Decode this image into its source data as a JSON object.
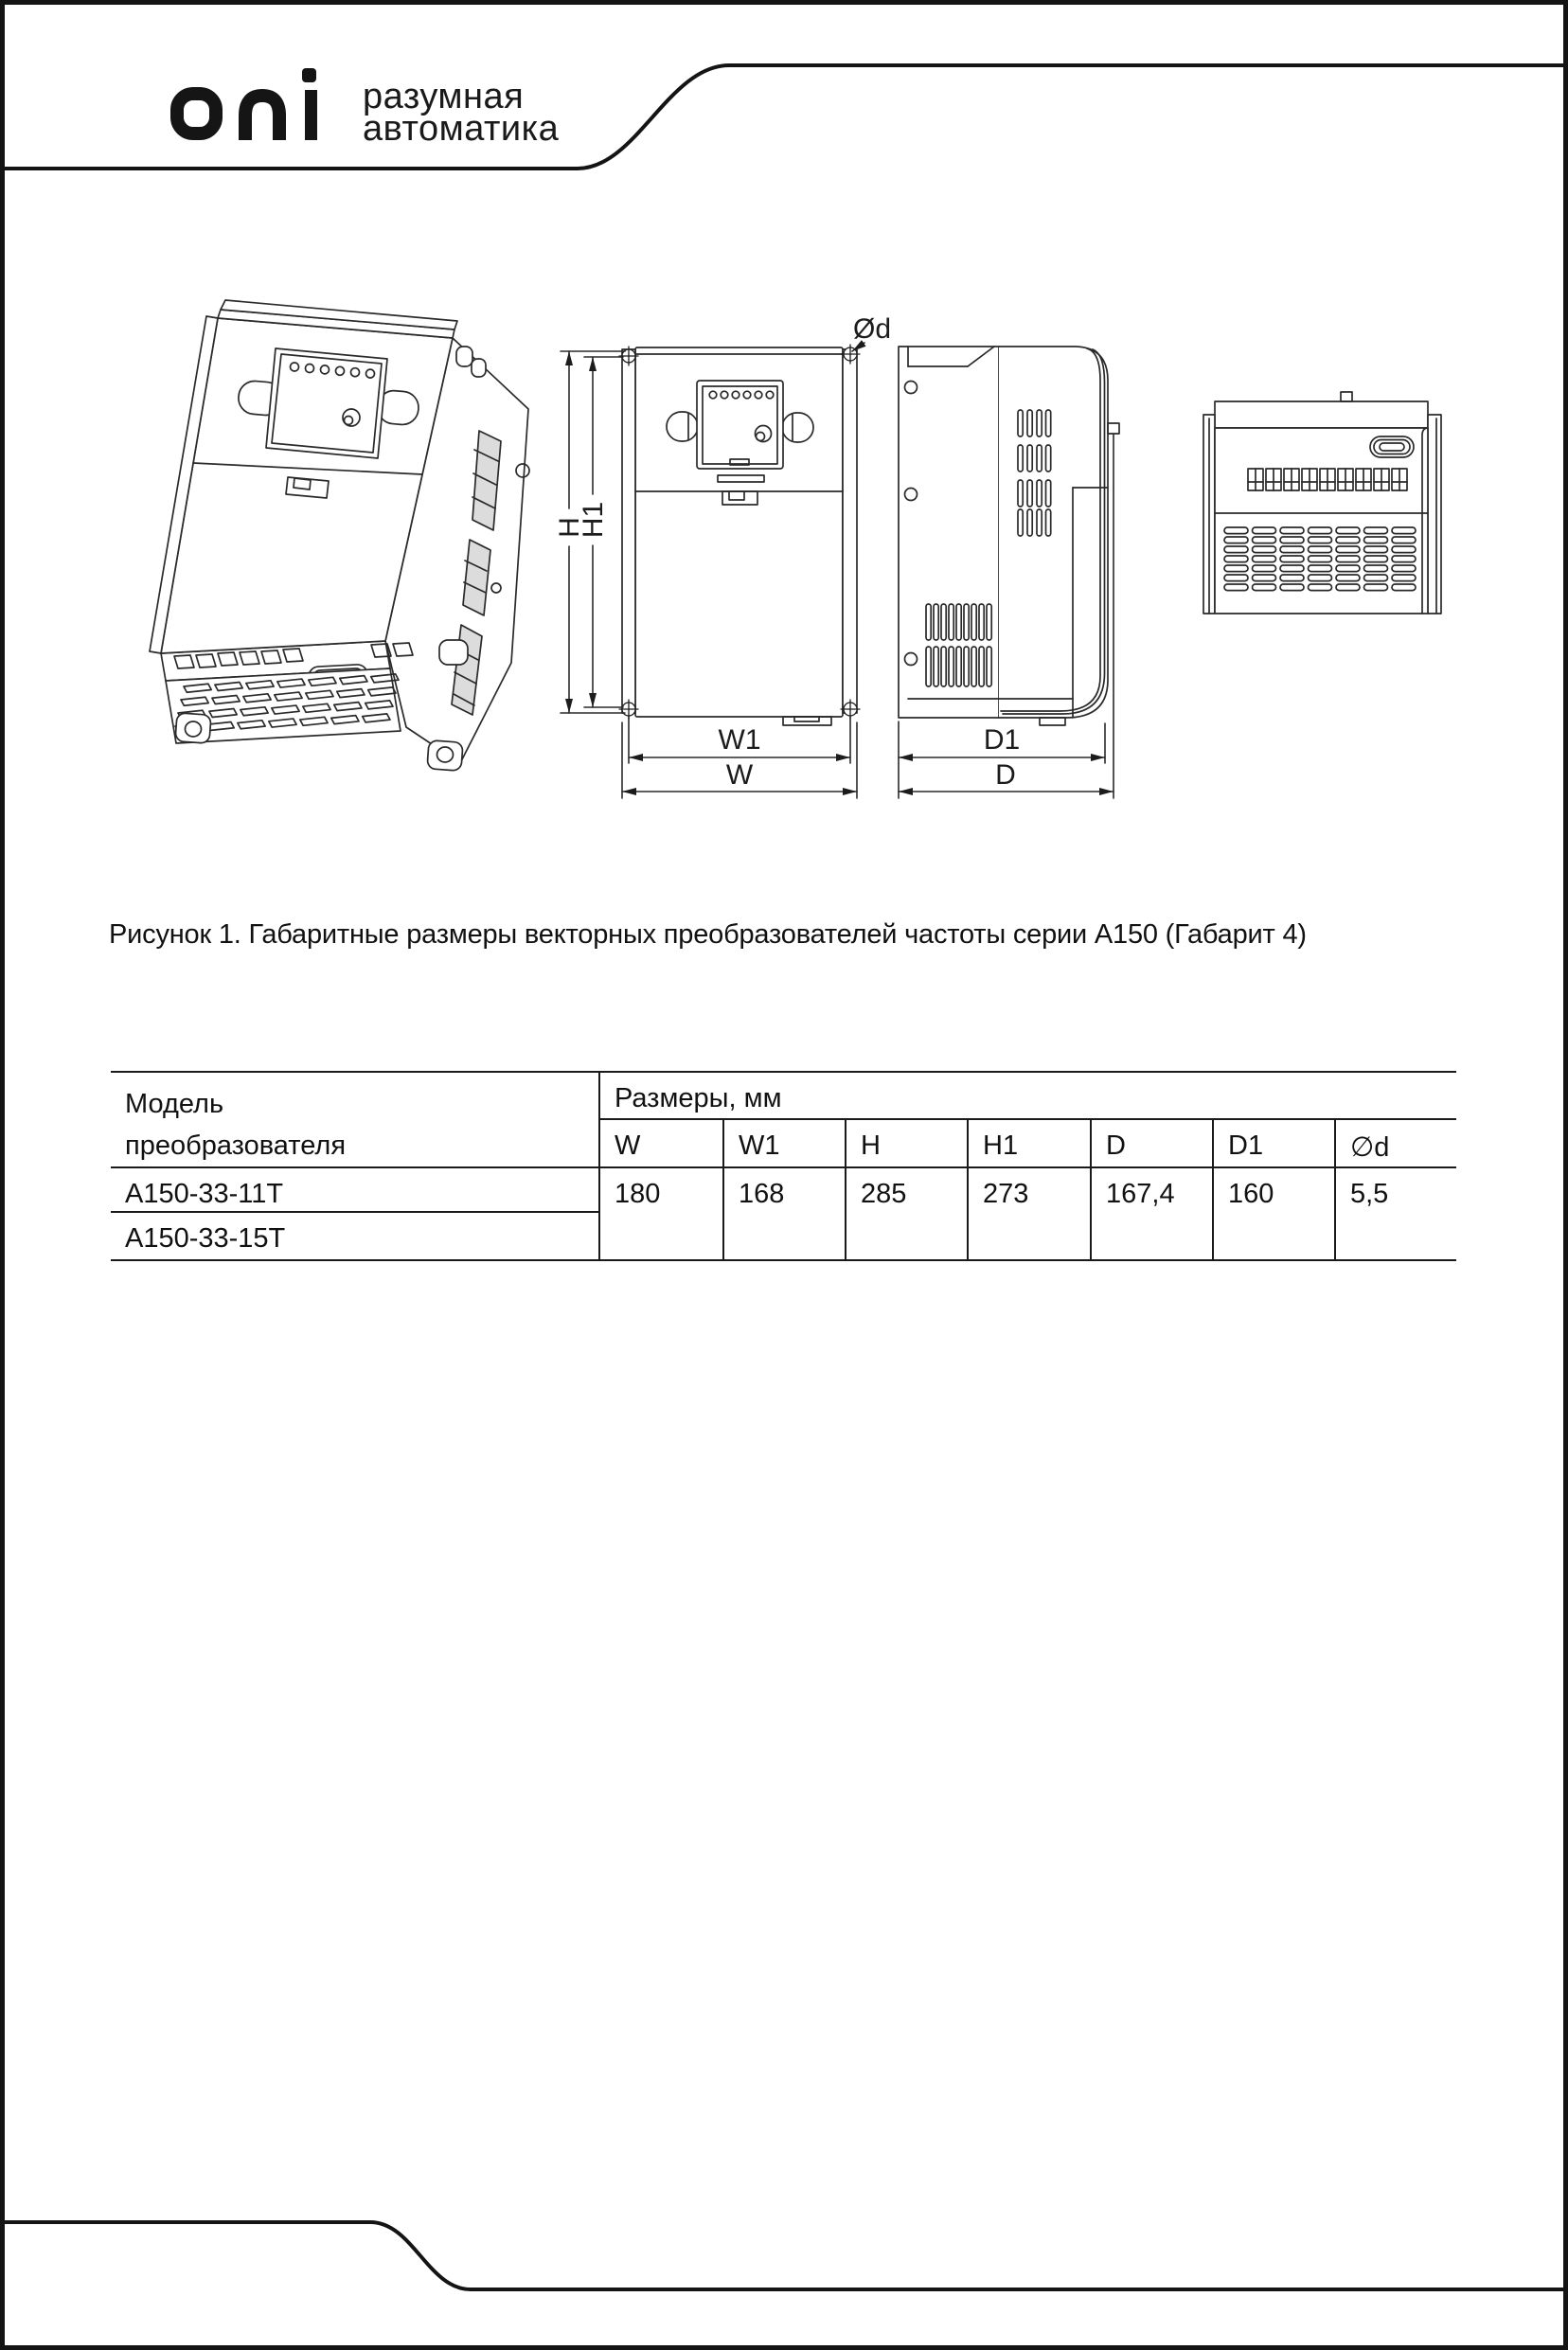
{
  "colors": {
    "ink": "#1c1c1c",
    "background": "#ffffff"
  },
  "brand": {
    "logo_text": "oni",
    "tagline_line1": "разумная",
    "tagline_line2": "автоматика"
  },
  "figure": {
    "caption": "Рисунок 1. Габаритные размеры векторных преобразователей частоты серии А150 (Габарит 4)"
  },
  "drawing": {
    "labels": {
      "height_total": "H",
      "height_mount": "H1",
      "width_mount": "W1",
      "width_total": "W",
      "depth_mount": "D1",
      "depth_total": "D",
      "hole_dia": "Ød"
    }
  },
  "table": {
    "col1_header_line1": "Модель",
    "col1_header_line2": "преобразователя",
    "dim_header": "Размеры, мм",
    "columns": [
      "W",
      "W1",
      "H",
      "H1",
      "D",
      "D1",
      "∅d"
    ],
    "models": [
      "А150-33-11Т",
      "А150-33-15Т"
    ],
    "values": [
      "180",
      "168",
      "285",
      "273",
      "167,4",
      "160",
      "5,5"
    ]
  }
}
